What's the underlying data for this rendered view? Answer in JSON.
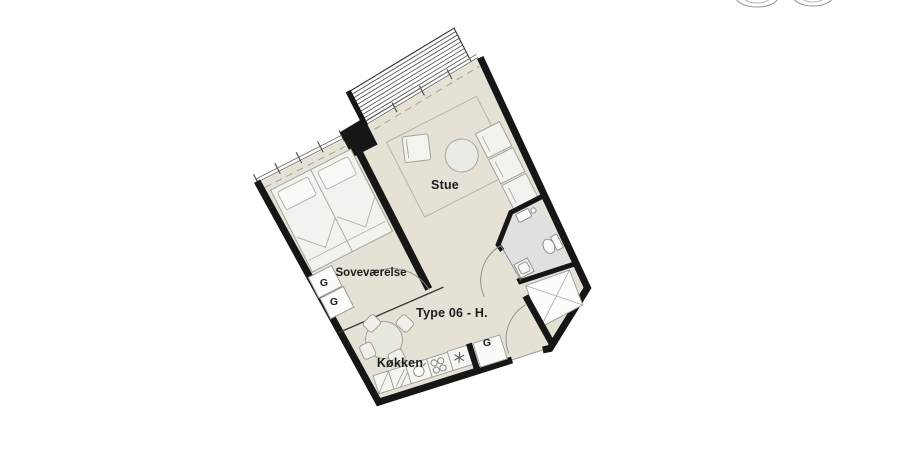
{
  "canvas": {
    "width": 905,
    "height": 460,
    "background": "#ffffff"
  },
  "plan": {
    "unit_label": "Type 06 - H.",
    "rooms": {
      "living": "Stue",
      "bedroom": "Soveværelse",
      "kitchen": "Køkken"
    },
    "wardrobes": [
      "G",
      "G",
      "G"
    ],
    "icons": {
      "fridge_symbol": "six-spoke-asterisk-icon",
      "bed": "double-bed-icon",
      "sofa": "three-module-sofa-icon",
      "coffee_table": "round-table-icon",
      "dining_set": "round-table-four-chairs-icon",
      "toilet": "toilet-icon",
      "washbasin": "washbasin-icon",
      "sink": "kitchen-sink-icon",
      "stove": "four-burner-stove-icon",
      "storage_cross": "crossed-storage-box-icon",
      "door_swing": "door-swing-arc-icon"
    },
    "colors": {
      "floor": "#e5e1d4",
      "bathroom_floor": "#e0e0de",
      "wall": "#161616",
      "furniture_fill": "#f3f3ef",
      "furniture_outline": "#a6a39a",
      "deck_stripe": "#4a4a4a"
    }
  }
}
